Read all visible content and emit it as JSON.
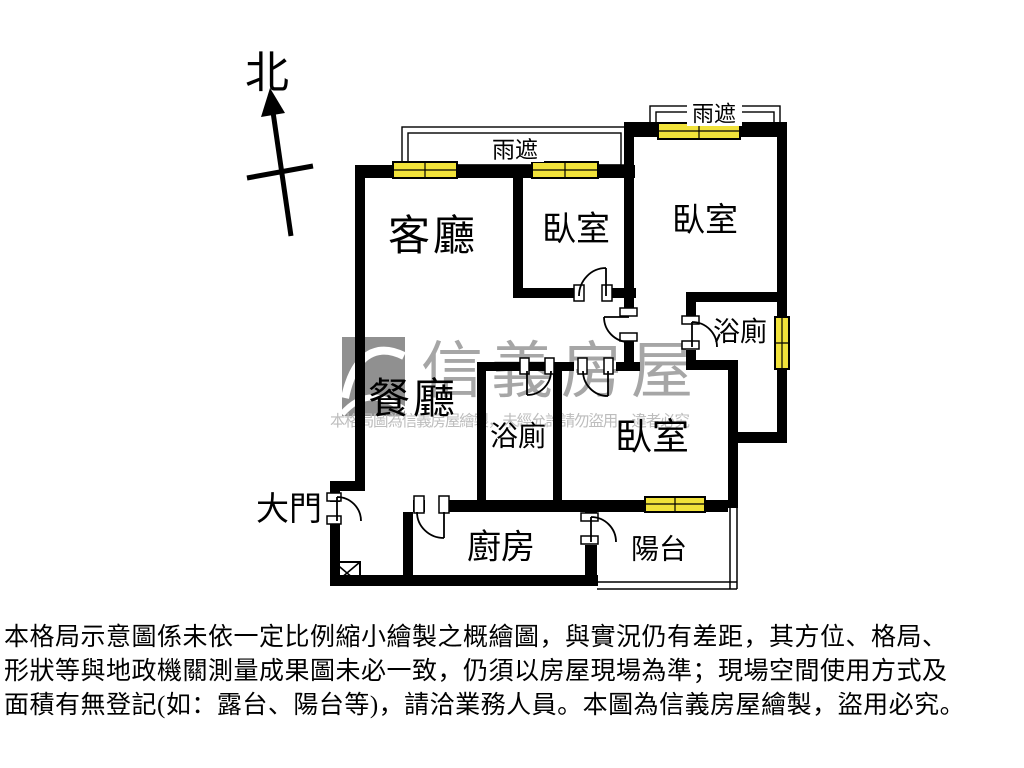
{
  "compass": {
    "north_label": "北"
  },
  "rooms": {
    "living_room": "客廳",
    "dining_room": "餐廳",
    "bedroom_top_middle": "臥室",
    "bedroom_top_right": "臥室",
    "bedroom_bottom": "臥室",
    "bathroom_upper": "浴廁",
    "bathroom_lower": "浴廁",
    "kitchen": "廚房",
    "balcony": "陽台",
    "main_entrance": "大門",
    "rain_canopy_left": "雨遮",
    "rain_canopy_right": "雨遮"
  },
  "watermark": {
    "brand": "信義房屋",
    "notice": "本格局圖為信義房屋繪製，未經允許請勿盜用，違者必究"
  },
  "disclaimer": {
    "line1": "本格局示意圖係未依一定比例縮小繪製之概繪圖，與實況仍有差距，其方位、格局、",
    "line2": "形狀等與地政機關測量成果圖未必一致，仍須以房屋現場為準；現場空間使用方式及",
    "line3": "面積有無登記(如：露台、陽台等)，請洽業務人員。本圖為信義房屋繪製，盜用必究。"
  },
  "colors": {
    "wall": "#000000",
    "window_fill": "#f1e23a",
    "watermark_gray": "#a6a6a6"
  }
}
